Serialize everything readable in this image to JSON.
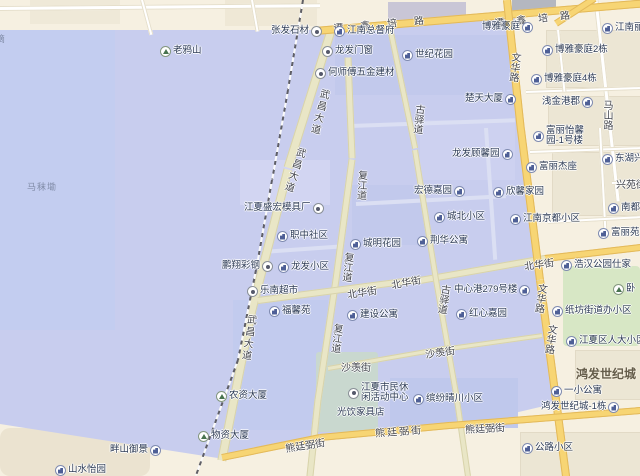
{
  "map_colors": {
    "highlight_region": "#c8cdee",
    "base": "#f6f0e1",
    "major_road": "#f7d574",
    "green_area": "#d7e7c5"
  },
  "roads": {
    "tanxinpeilu": "谭鑫培路",
    "wuchangdadao": "武昌大道",
    "fujiangdao": "复江道",
    "beihuajie": "北华街",
    "guyidao": "古驿道",
    "wenhualu": "文华路",
    "mashanlu": "马山路",
    "xiongtingbijie": "熊廷弼街",
    "shayanjie": "沙羡街",
    "xingyuanjie": "兴苑街"
  },
  "areas": {
    "hongfa_shijicheng": "鸿发世纪城",
    "mamokan": "马秣墈",
    "left_edge_partial": "滴"
  },
  "pois": {
    "laoyashan": "老鸦山",
    "zhangfa_shicai": "张发石材",
    "jiangnan_zongdufu": "江南总督府",
    "longfa_menchuang": "龙发门窗",
    "shiji_huayuan": "世纪花园",
    "heshifu_wujin": "何师傅五金建材",
    "chutian_dasha": "楚天大厦",
    "boya_haoting": "博雅豪庭",
    "jiangnan_lidu": "江南丽都",
    "boya_haoting_2": "博雅豪庭2栋",
    "boya_haoting_4": "博雅豪庭4栋",
    "qianjin_gangjun": "浅金港郡",
    "fuli_yixin_1": "富丽怡馨",
    "fuli_yixin_2": "园-1号楼",
    "donghu_xing": "东湖兴城",
    "fuli_jiezuo": "富丽杰座",
    "xinxin_jiayuan": "欣馨家园",
    "longfa_guxinyuan": "龙发顾馨园",
    "chengbei_xiaoqu": "城北小区",
    "jiangnan_jingdu_xiaoqu": "江南京都小区",
    "hongde_jiayuan": "宏德嘉园",
    "jinghua_gongyu": "荆华公寓",
    "jiangxia_shenghong_mujuchang": "江夏盛宏模具厂",
    "zhizhong_shequ": "职中社区",
    "pengxiang_caigang": "鹏翔彩钢",
    "longfa_xiaoqu": "龙发小区",
    "lenan_chaoshi": "乐南超市",
    "fuxinyuan": "福馨苑",
    "jianshe_gongyu": "建设公寓",
    "chengming_huayuan": "城明花园",
    "hongxin_jiayuan": "红心嘉园",
    "zhongxingang_279": "中心港279号楼",
    "zhifang_jiedaoban": "纸坊街道办小区",
    "jiangxia_renda": "江夏区人大小区",
    "haohan_gongyuan_shijia": "浩汉公园仕家",
    "yixiao_gongyu": "一小公寓",
    "hongfa_1dong": "鸿发世纪城-1栋",
    "gonglu_xiaoqu": "公路小区",
    "binfen_qingchuan": "缤纷晴川小区",
    "shimin_center_1": "江夏市民休",
    "shimin_center_2": "闲活动中心",
    "guangyin_jiajudian": "光饮家具店",
    "nongzi_dasha": "农资大厦",
    "wuzi_dasha": "物资大厦",
    "panshan_yujing": "畔山御景",
    "shanshui_yiyuan": "山水怡园",
    "nandu": "南都",
    "fuli_yuan": "富丽苑",
    "wolong_partial": "卧"
  }
}
